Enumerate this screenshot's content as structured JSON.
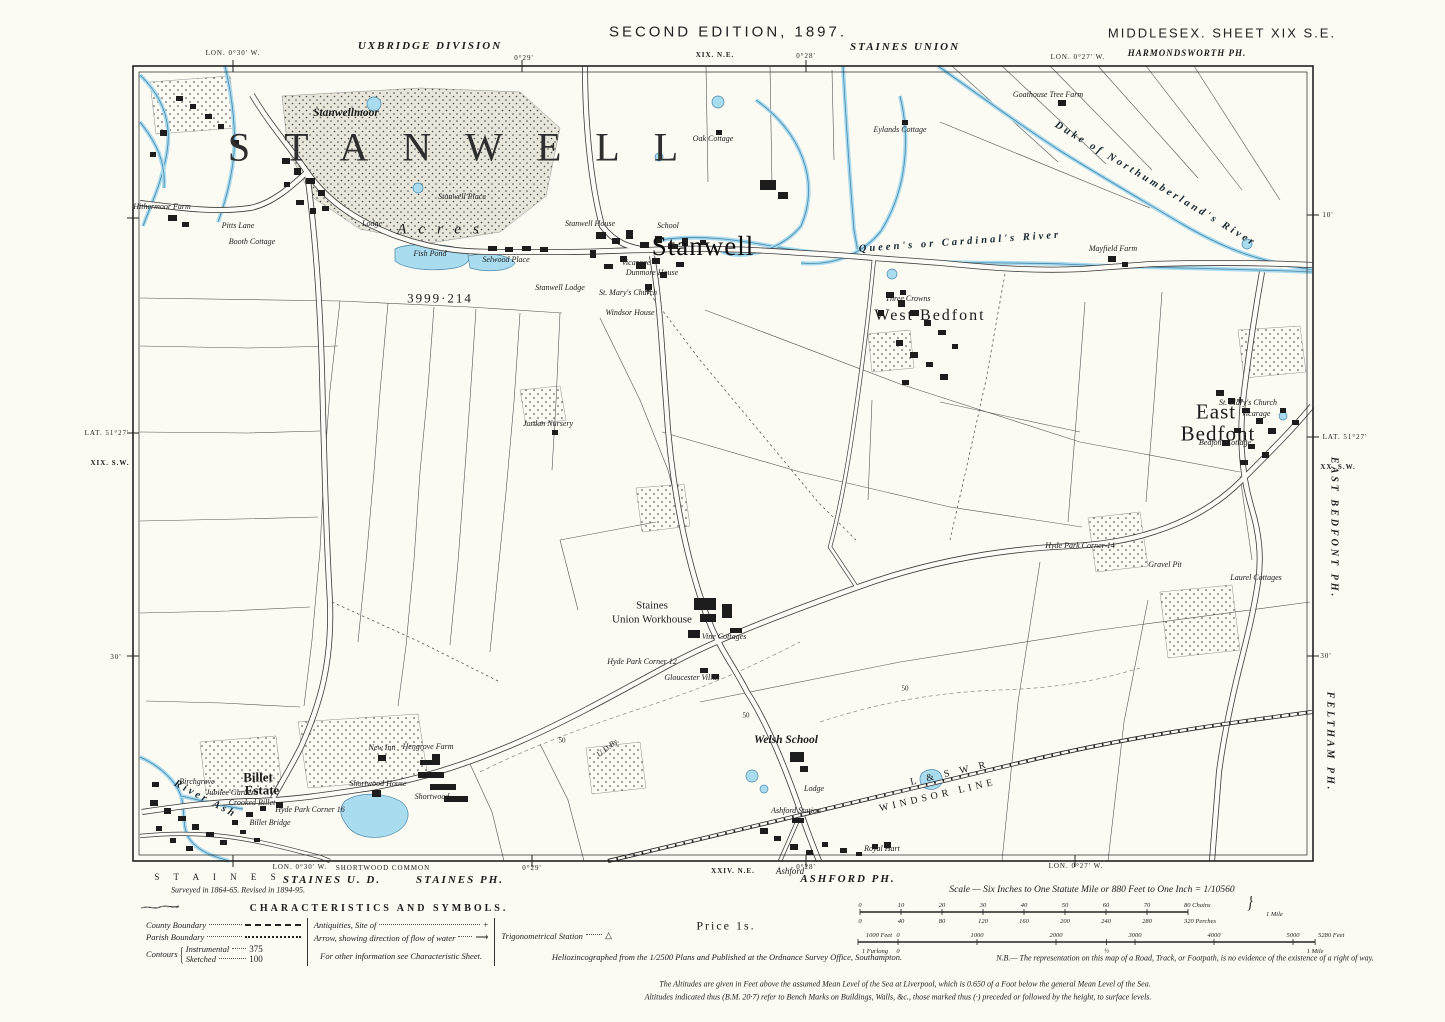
{
  "header": {
    "edition": "SECOND EDITION, 1897.",
    "division": "UXBRIDGE DIVISION",
    "union": "STAINES UNION",
    "county_sheet": "MIDDLESEX.   SHEET XIX S.E.",
    "parish_top": "HARMONDSWORTH PH.",
    "sheet_ne": "XIX. N.E.",
    "lon30": "LON. 0°30' W.",
    "m29": "0°29'",
    "m28": "0°28'",
    "lon27": "LON. 0°27' W."
  },
  "margins": {
    "left": {
      "lat": "LAT. 51°27'",
      "sheet": "XIX. S.W.",
      "m30": "30'"
    },
    "right": {
      "m10": "10'",
      "lat": "LAT. 51°27'",
      "sheet": "XX. S.W.",
      "parish_east": "EAST BEDFONT PH.",
      "m30": "30'",
      "parish_feltham": "FELTHAM PH."
    }
  },
  "bottom": {
    "staines_sp": "S T A I N E S",
    "lon30": "LON. 0°30' W.",
    "staines_ud": "STAINES U. D.",
    "surveyed": "Surveyed in 1864-65.  Revised in 1894-95.",
    "shortwood": "SHORTWOOD COMMON",
    "staines_ph": "STAINES PH.",
    "m29": "0°29'",
    "m28": "0°28'",
    "sheet": "XXIV. N.E.",
    "ashford_i": "Ashford",
    "ashford_ph": "ASHFORD PH.",
    "lon27": "LON. 0°27' W."
  },
  "legend": {
    "title": "CHARACTERISTICS AND SYMBOLS.",
    "county": "County Boundary",
    "parish": "Parish Boundary",
    "contours": "Contours",
    "instrumental": "Instrumental",
    "sketched": "Sketched",
    "contour_instr_val": "375",
    "contour_sketch_val": "100",
    "antiquities": "Antiquities, Site of",
    "antiquities_sym": "+",
    "arrow": "Arrow, showing direction of flow of water",
    "arrow_sym": "⟶",
    "trig": "Trigonometrical Station",
    "trig_sym": "△",
    "more": "For other information see Characteristic Sheet."
  },
  "notes": {
    "price": "Price 1s.",
    "helio": "Heliozincographed from the 1/2500 Plans and Published at the Ordnance Survey Office, Southampton.",
    "nb": "N.B.— The representation on this map of a Road, Track, or Footpath, is no evidence of the existence of a right of way.",
    "alt1": "The Altitudes are given in Feet above the assumed Mean Level of the Sea at Liverpool, which is 0.650 of a Foot below the general Mean Level of the Sea.",
    "alt2": "Altitudes indicated thus (B.M. 20·7) refer to Bench Marks on Buildings, Walls, &c., those marked thus (·) preceded or followed by the height, to surface levels."
  },
  "scalebar": {
    "title": "Scale — Six Inches to One Statute Mile or 880 Feet to One Inch = 1/10560",
    "chains": [
      "0",
      "10",
      "20",
      "30",
      "40",
      "50",
      "60",
      "70"
    ],
    "chains_end": "80 Chains",
    "perches": [
      "0",
      "40",
      "80",
      "120",
      "160",
      "200",
      "240",
      "280"
    ],
    "perches_end": "320 Perches",
    "mile_brace": "1 Mile",
    "feet_prefix": "1000 Feet",
    "feet": [
      "0",
      "1000",
      "2000",
      "3000",
      "4000",
      "5000"
    ],
    "feet_end": "5280 Feet",
    "furlong_prefix": "1 Furlong",
    "furlong_zero": "0",
    "furlong_half": "½",
    "furlong_end": "1 Mile"
  },
  "map": {
    "labels": [
      {
        "t": "STANWELL",
        "x": 470,
        "y": 148,
        "c": "giant"
      },
      {
        "t": "Stanwellmoor",
        "x": 346,
        "y": 114,
        "c": "ham2"
      },
      {
        "t": "Stanwell Place",
        "x": 462,
        "y": 197,
        "c": "tiny-i"
      },
      {
        "t": "Acres",
        "x": 444,
        "y": 230,
        "c": "spread"
      },
      {
        "t": "Fish Pond",
        "x": 430,
        "y": 254,
        "c": "tiny-i"
      },
      {
        "t": "Selwood Place",
        "x": 506,
        "y": 260,
        "c": "tiny-i"
      },
      {
        "t": "Lodge",
        "x": 372,
        "y": 224,
        "c": "tiny-i"
      },
      {
        "t": "Hithermoor Farm",
        "x": 162,
        "y": 207,
        "c": "tiny-i"
      },
      {
        "t": "Pitts Lane",
        "x": 238,
        "y": 226,
        "c": "tiny-i"
      },
      {
        "t": "Booth Cottage",
        "x": 252,
        "y": 242,
        "c": "tiny-i"
      },
      {
        "t": "Stanwell House",
        "x": 590,
        "y": 224,
        "c": "tiny-i"
      },
      {
        "t": "School",
        "x": 668,
        "y": 226,
        "c": "tiny-i"
      },
      {
        "t": "Stanwell",
        "x": 703,
        "y": 247,
        "c": "village"
      },
      {
        "t": "Vicarage",
        "x": 636,
        "y": 263,
        "c": "tiny-i"
      },
      {
        "t": "Dunmore House",
        "x": 652,
        "y": 273,
        "c": "tiny-i"
      },
      {
        "t": "Stanwell Lodge",
        "x": 560,
        "y": 288,
        "c": "tiny-i"
      },
      {
        "t": "St. Mary's Church",
        "x": 628,
        "y": 293,
        "c": "tiny-i"
      },
      {
        "t": "Windsor House",
        "x": 630,
        "y": 313,
        "c": "tiny-i"
      },
      {
        "t": "3999·214",
        "x": 440,
        "y": 298,
        "c": "acreage"
      },
      {
        "t": "Jordan Nursery",
        "x": 548,
        "y": 424,
        "c": "tiny-i"
      },
      {
        "t": "Oak Cottage",
        "x": 713,
        "y": 139,
        "c": "tiny-i"
      },
      {
        "t": "Eylands Cottage",
        "x": 900,
        "y": 130,
        "c": "tiny-i"
      },
      {
        "t": "Goathouse Tree Farm",
        "x": 1048,
        "y": 95,
        "c": "tiny-i"
      },
      {
        "t": "Duke of Northumberland's River",
        "x": 1155,
        "y": 185,
        "c": "river",
        "r": 31
      },
      {
        "t": "Queen's or Cardinal's River",
        "x": 960,
        "y": 243,
        "c": "river",
        "r": -4
      },
      {
        "t": "West Bedfont",
        "x": 930,
        "y": 316,
        "c": "village-md"
      },
      {
        "t": "Three Crowns",
        "x": 908,
        "y": 299,
        "c": "tiny-i"
      },
      {
        "t": "Mayfield Farm",
        "x": 1113,
        "y": 249,
        "c": "tiny-i"
      },
      {
        "t": "East",
        "x": 1216,
        "y": 412,
        "c": "village-xl"
      },
      {
        "t": "Bedfont",
        "x": 1218,
        "y": 434,
        "c": "village-xl"
      },
      {
        "t": "St. Mary's Church",
        "x": 1248,
        "y": 403,
        "c": "tiny-i"
      },
      {
        "t": "Vicarage",
        "x": 1256,
        "y": 414,
        "c": "tiny-i"
      },
      {
        "t": "Bedfont Cottage",
        "x": 1225,
        "y": 443,
        "c": "tiny-i"
      },
      {
        "t": "Laurel Cottages",
        "x": 1256,
        "y": 578,
        "c": "tiny-i"
      },
      {
        "t": "Gravel Pit",
        "x": 1165,
        "y": 565,
        "c": "tiny-i"
      },
      {
        "t": "Hyde Park Corner 14",
        "x": 1080,
        "y": 546,
        "c": "tiny-i"
      },
      {
        "t": "Staines",
        "x": 652,
        "y": 606,
        "c": "ham-u"
      },
      {
        "t": "Union Workhouse",
        "x": 652,
        "y": 620,
        "c": "ham-u"
      },
      {
        "t": "Vine Cottages",
        "x": 724,
        "y": 637,
        "c": "tiny-i"
      },
      {
        "t": "Gloucester Villas",
        "x": 692,
        "y": 678,
        "c": "tiny-i"
      },
      {
        "t": "Hyde Park Corner 12",
        "x": 642,
        "y": 662,
        "c": "tiny-i"
      },
      {
        "t": "Welsh School",
        "x": 786,
        "y": 741,
        "c": "ham2"
      },
      {
        "t": "Lodge",
        "x": 814,
        "y": 789,
        "c": "tiny-i"
      },
      {
        "t": "Ashford Station",
        "x": 796,
        "y": 811,
        "c": "tiny-i"
      },
      {
        "t": "L & S W R",
        "x": 950,
        "y": 774,
        "c": "rail",
        "r": -13
      },
      {
        "t": "WINDSOR LINE",
        "x": 938,
        "y": 796,
        "c": "rail",
        "r": -13
      },
      {
        "t": "Royal Hart",
        "x": 882,
        "y": 849,
        "c": "tiny-i"
      },
      {
        "t": "New Inn",
        "x": 382,
        "y": 748,
        "c": "tiny-i"
      },
      {
        "t": "Billet",
        "x": 258,
        "y": 777,
        "c": "village-sm"
      },
      {
        "t": "Estate",
        "x": 262,
        "y": 790,
        "c": "village-sm"
      },
      {
        "t": "Jubilee Gardens",
        "x": 232,
        "y": 793,
        "c": "tiny-i"
      },
      {
        "t": "Crooked Billet",
        "x": 252,
        "y": 803,
        "c": "tiny-i"
      },
      {
        "t": "Billet Bridge",
        "x": 270,
        "y": 823,
        "c": "tiny-i"
      },
      {
        "t": "Hyde Park Corner 16",
        "x": 310,
        "y": 810,
        "c": "tiny-i"
      },
      {
        "t": "Shortwood House",
        "x": 378,
        "y": 784,
        "c": "tiny-i"
      },
      {
        "t": "Shortwood",
        "x": 432,
        "y": 797,
        "c": "tiny-i"
      },
      {
        "t": "Birchgrove",
        "x": 197,
        "y": 782,
        "c": "tiny-i"
      },
      {
        "t": "Hengrove Farm",
        "x": 428,
        "y": 747,
        "c": "tiny-i"
      },
      {
        "t": "River Ash",
        "x": 205,
        "y": 800,
        "c": "river",
        "r": 28
      },
      {
        "t": "U.D.By.",
        "x": 608,
        "y": 748,
        "c": "tiny-i",
        "r": -38
      },
      {
        "t": "50",
        "x": 562,
        "y": 741,
        "c": "tiny"
      },
      {
        "t": "50",
        "x": 746,
        "y": 716,
        "c": "tiny"
      },
      {
        "t": "50",
        "x": 905,
        "y": 689,
        "c": "tiny"
      }
    ]
  }
}
